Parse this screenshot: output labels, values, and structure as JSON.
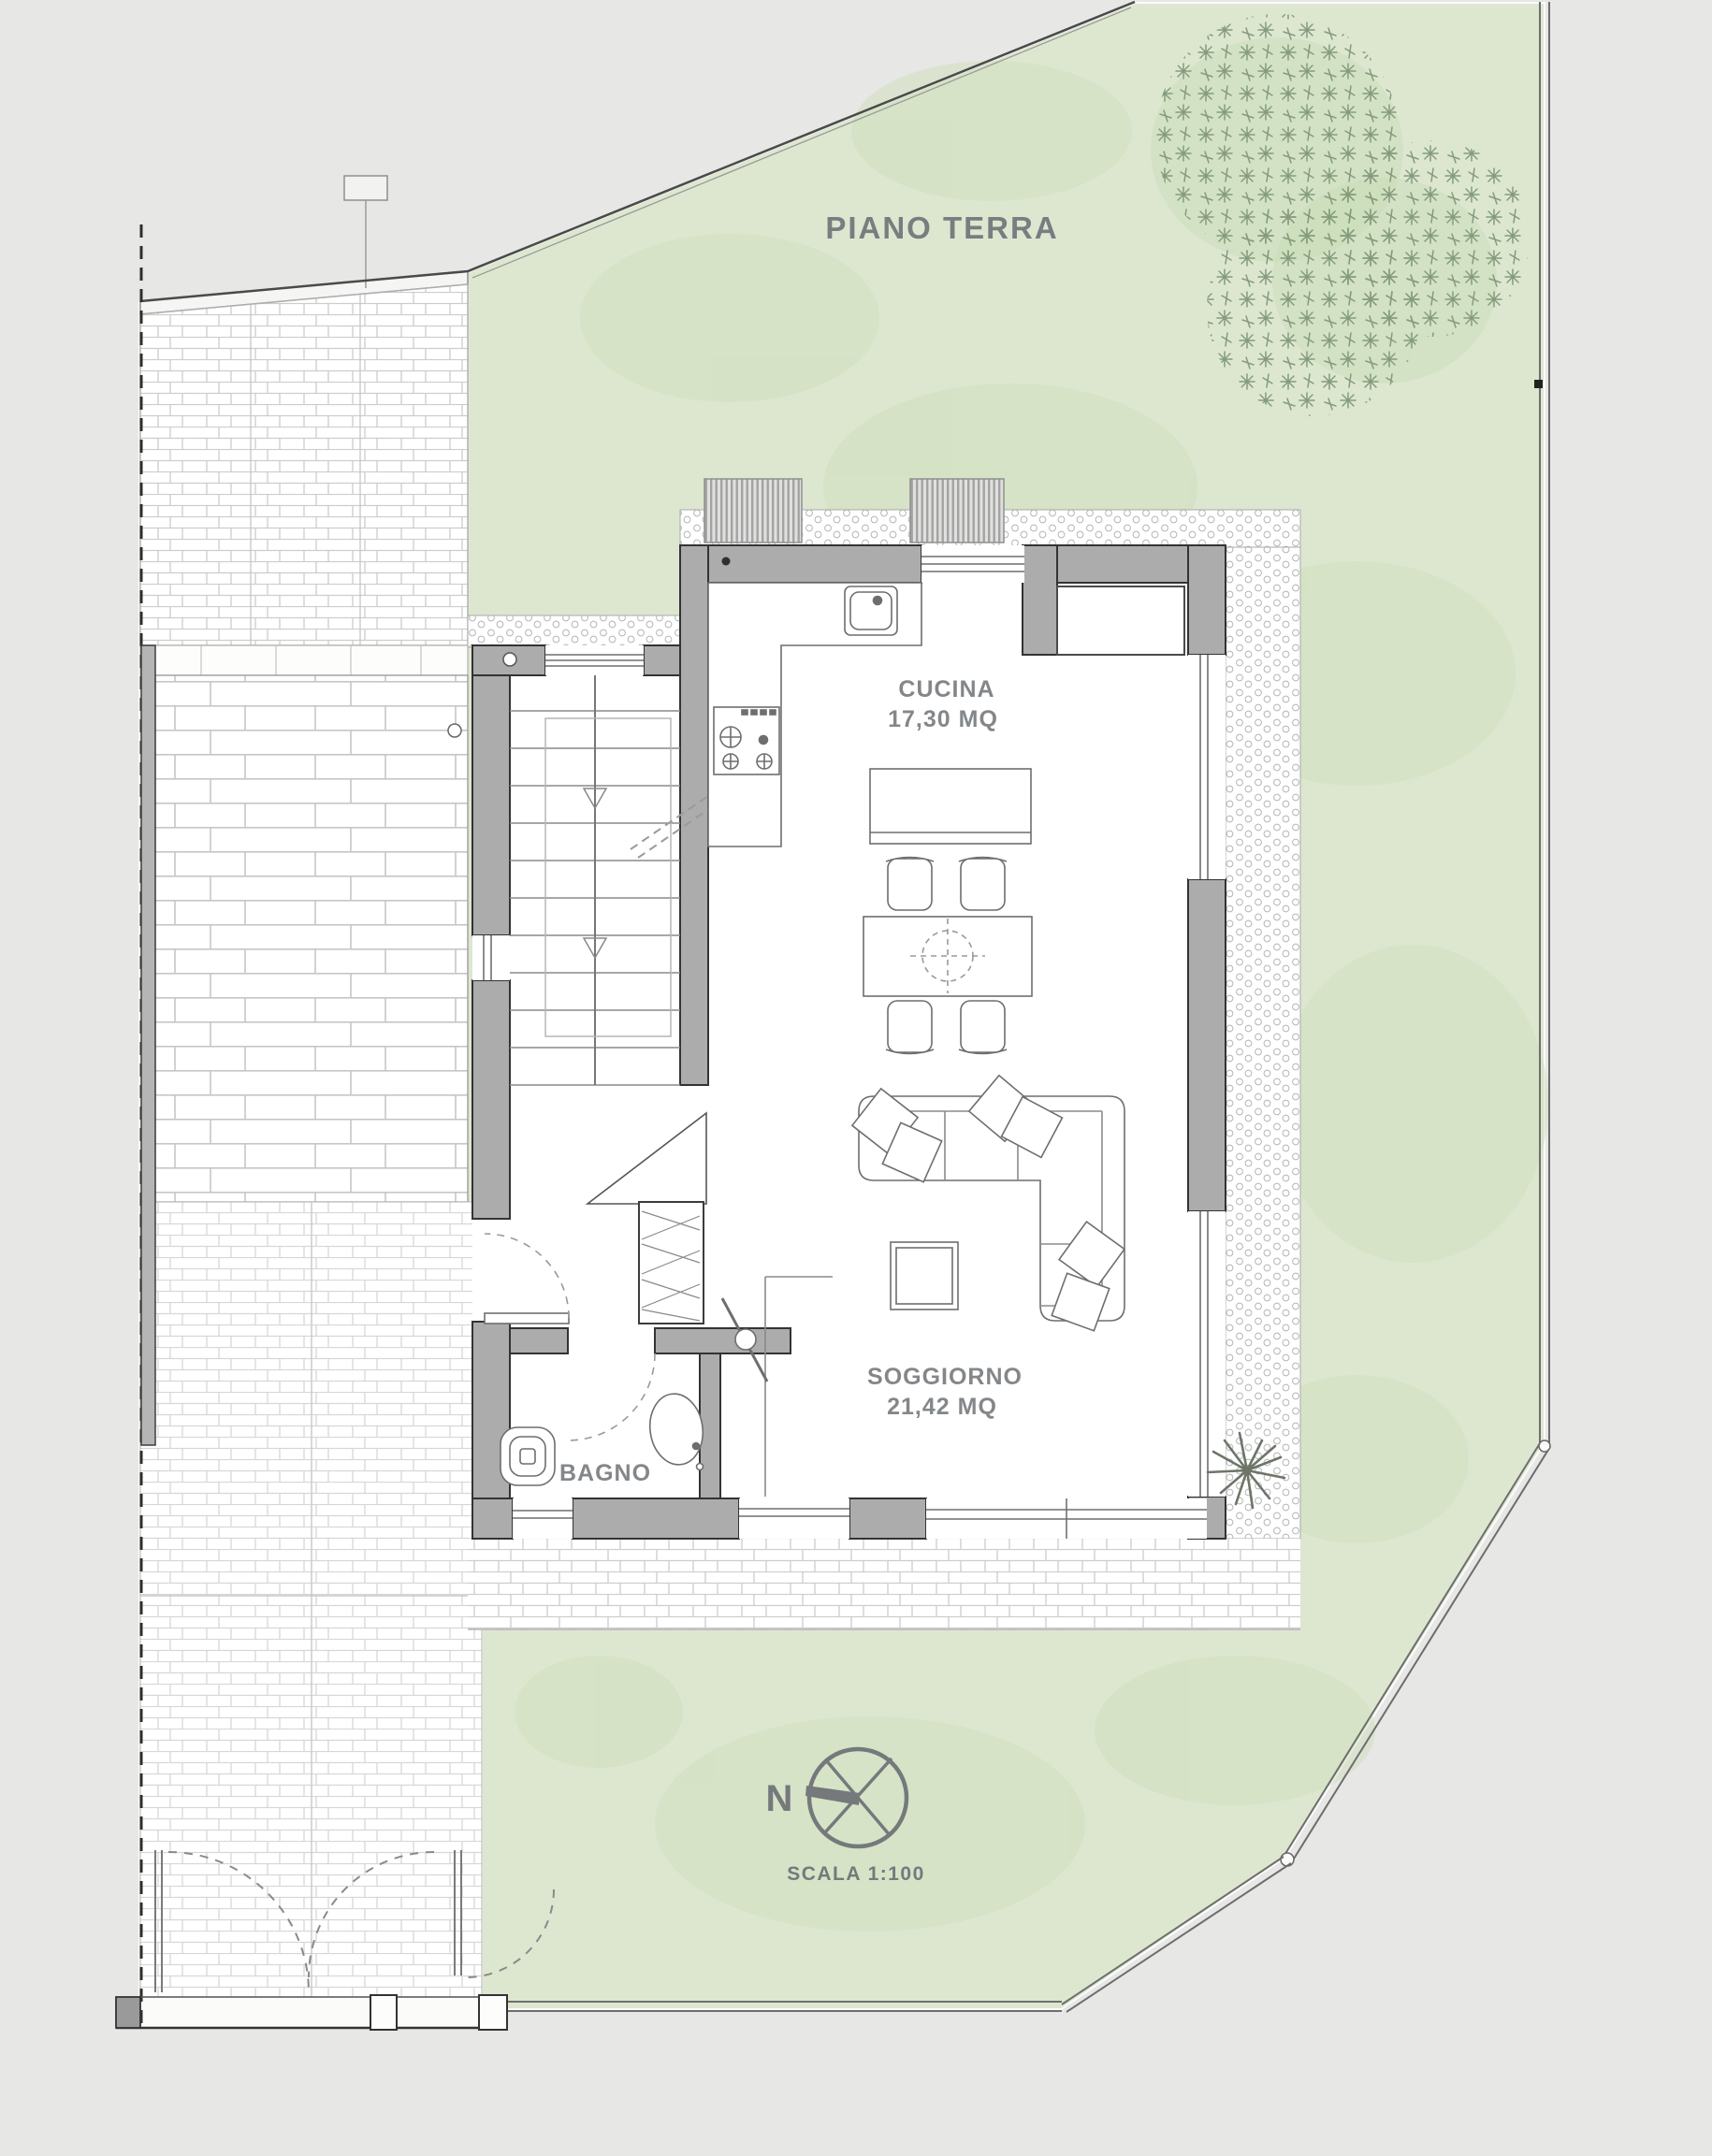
{
  "title": "PIANO TERRA",
  "rooms": [
    {
      "name": "CUCINA",
      "area": "17,30 MQ"
    },
    {
      "name": "SOGGIORNO",
      "area": "21,42 MQ"
    },
    {
      "name": "BAGNO",
      "area": ""
    }
  ],
  "compass": {
    "north_label": "N"
  },
  "scale": {
    "label": "SCALA 1:100"
  },
  "colors": {
    "background": "#e7e7e5",
    "lawn": "#dde7d0",
    "lawn_shade": "#cfdfbc",
    "foliage": "#849c7c",
    "wall_fill": "#acacac",
    "wall_outline": "#333333",
    "label_gray": "#84878a"
  }
}
